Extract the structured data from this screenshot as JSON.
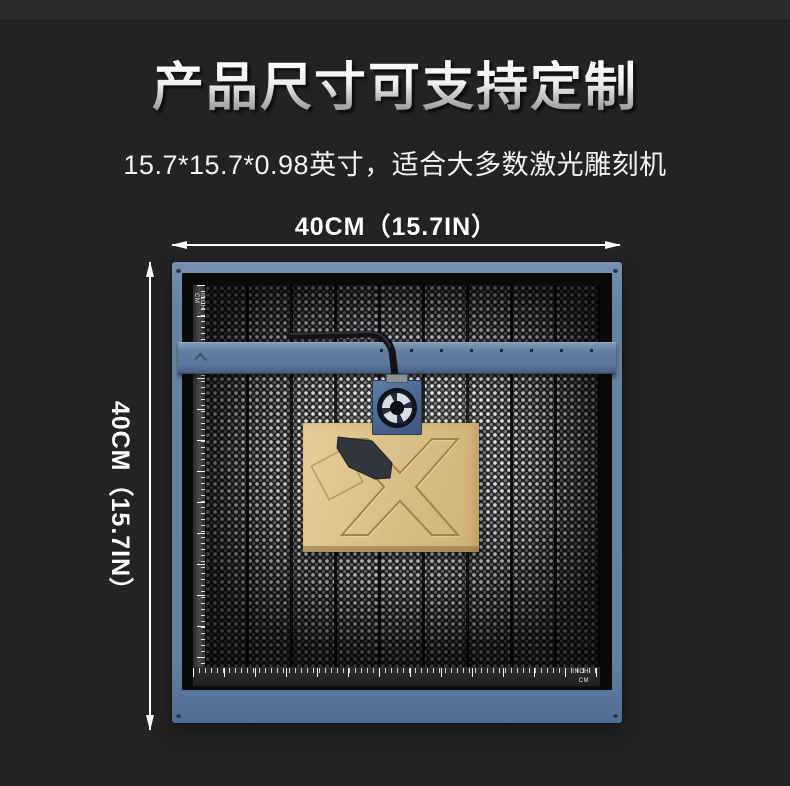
{
  "page": {
    "background": "#232323",
    "top_band": "#2a2a2a"
  },
  "header": {
    "title": "产品尺寸可支持定制",
    "subtitle": "15.7*15.7*0.98英寸，适合大多数激光雕刻机"
  },
  "dimensions": {
    "width_label": "40CM（15.7IN）",
    "height_label": "40CM（15.7IN）"
  },
  "product": {
    "frame_color": "#64809f",
    "honeycomb_color": "#191919",
    "board_color": "#dcc089",
    "engraving_letter": "X",
    "left_ruler": {
      "labels": [
        "CM",
        "INCH"
      ]
    },
    "bottom_ruler": {
      "labels": [
        "INCH",
        "CM"
      ]
    }
  }
}
